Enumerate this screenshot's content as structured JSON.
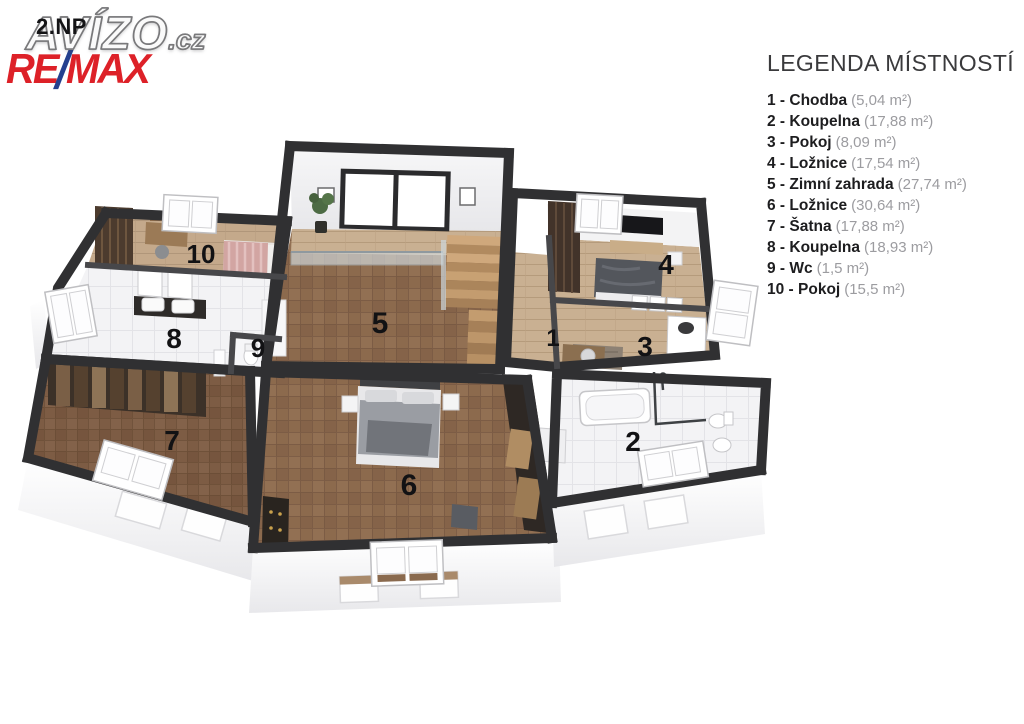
{
  "branding": {
    "floor_label": "2.NP",
    "watermark_main": "AVÍZO",
    "watermark_suffix": ".cz",
    "remax_re": "RE",
    "remax_slash": "/",
    "remax_max": "MAX"
  },
  "colors": {
    "remax_red": "#DD2128",
    "remax_blue": "#24408F",
    "wall_dark": "#303032",
    "wood_parquet": "#8C6A4D",
    "wood_plank_light": "#C9B092",
    "bath_floor": "#F2F2F4"
  },
  "legend": {
    "title": "LEGENDA MÍSTNOSTÍ",
    "items": [
      {
        "label": "1 - Chodba",
        "area": "(5,04 m²)"
      },
      {
        "label": "2 - Koupelna",
        "area": "(17,88 m²)"
      },
      {
        "label": "3 - Pokoj",
        "area": "(8,09 m²)"
      },
      {
        "label": "4 - Ložnice",
        "area": "(17,54 m²)"
      },
      {
        "label": "5 - Zimní zahrada",
        "area": "(27,74 m²)"
      },
      {
        "label": "6 - Ložnice",
        "area": "(30,64 m²)"
      },
      {
        "label": "7 - Šatna",
        "area": "(17,88 m²)"
      },
      {
        "label": "8 - Koupelna",
        "area": "(18,93 m²)"
      },
      {
        "label": "9 - Wc",
        "area": "(1,5 m²)"
      },
      {
        "label": "10 - Pokoj",
        "area": "(15,5 m²)"
      }
    ]
  },
  "plan": {
    "labels": [
      "1",
      "2",
      "3",
      "4",
      "5",
      "6",
      "7",
      "8",
      "9",
      "10"
    ]
  }
}
